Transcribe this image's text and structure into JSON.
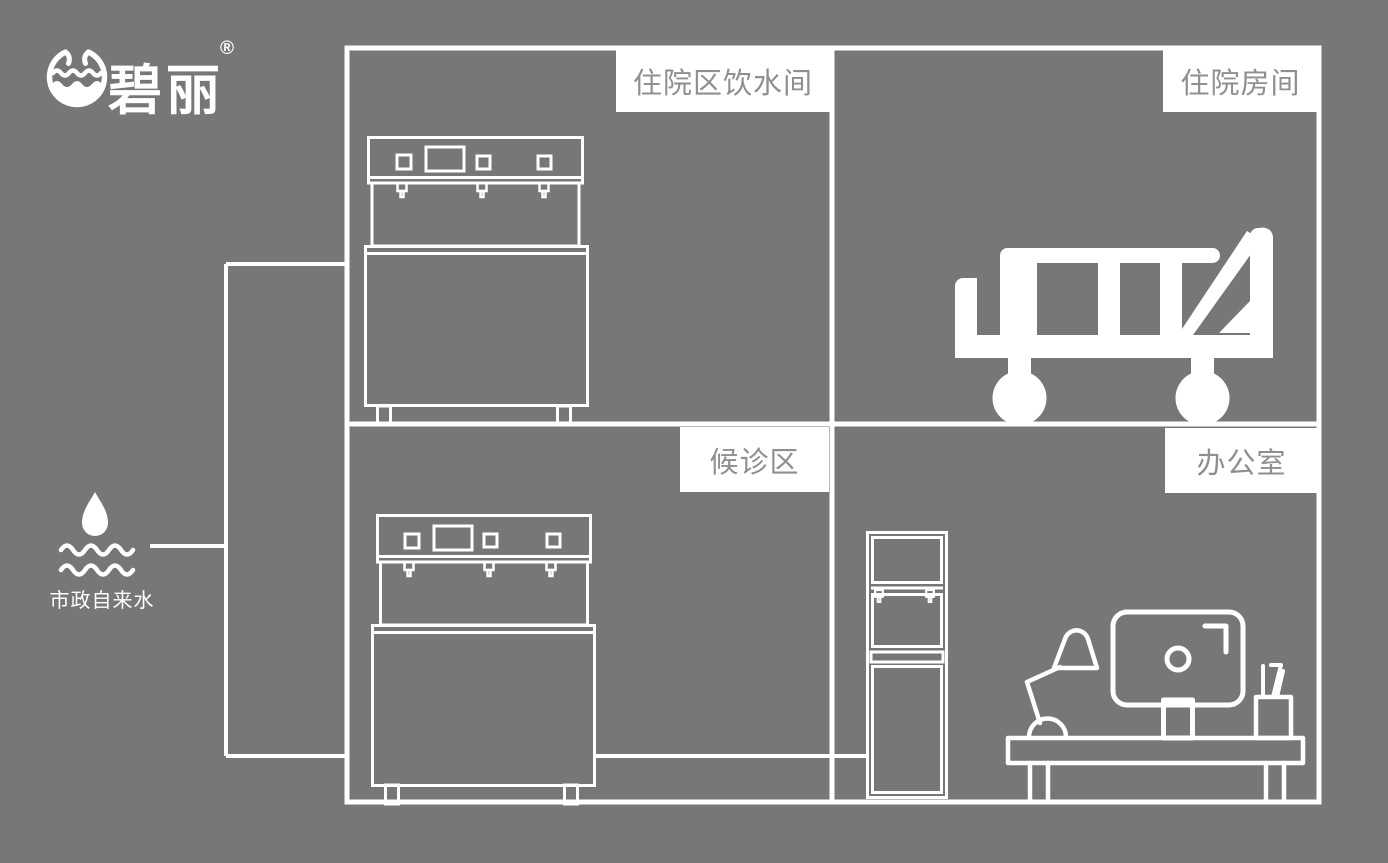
{
  "colors": {
    "background": "#77777a",
    "line_art": "#ffffff",
    "label_bg": "#ffffff",
    "label_text": "#8f8f92"
  },
  "logo": {
    "brand": "碧丽",
    "trademark": "®",
    "icon": "water-bowl-logo-icon"
  },
  "water_source": {
    "label": "市政自来水",
    "icon": "water-drop-icon"
  },
  "rooms": [
    {
      "id": "inpatient-drinking-room",
      "label": "住院区饮水间",
      "icon": "countertop-water-dispenser-icon"
    },
    {
      "id": "inpatient-room",
      "label": "住院房间",
      "icon": "hospital-bed-icon"
    },
    {
      "id": "waiting-area",
      "label": "候诊区",
      "icon": "countertop-water-dispenser-icon"
    },
    {
      "id": "office",
      "label": "办公室",
      "icon": "vertical-water-dispenser-icon, desk-lamp-icon, monitor-icon, pen-holder-icon, desk-icon"
    }
  ]
}
